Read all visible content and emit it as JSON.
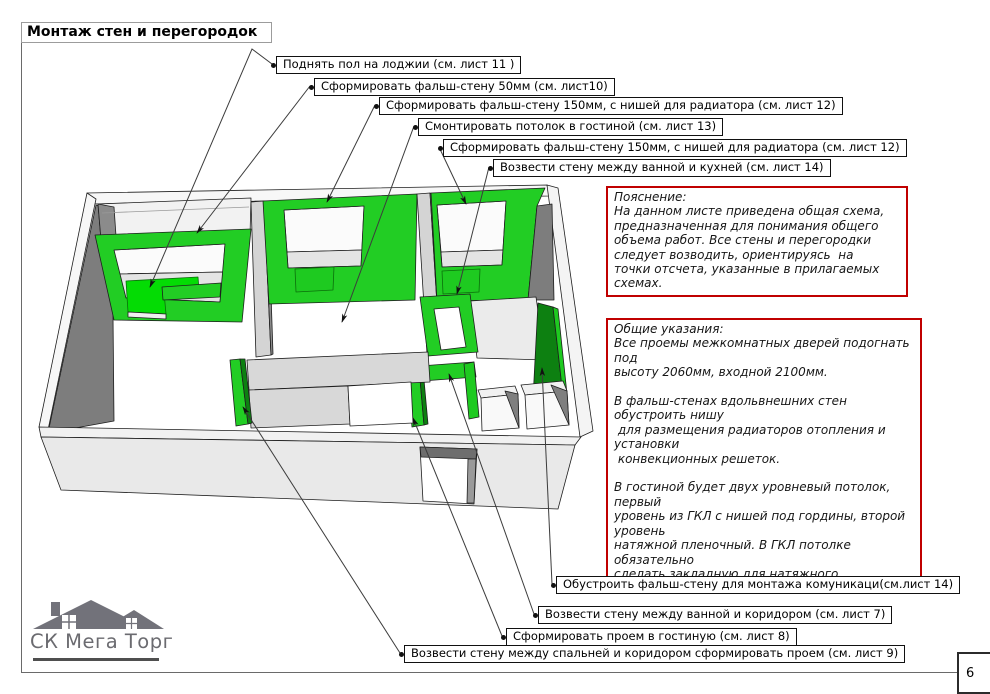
{
  "sheet": {
    "title": "Монтаж стен и перегородок",
    "page_number": "6"
  },
  "callouts": [
    {
      "label": "Поднять пол на лоджии (см. лист 11 )"
    },
    {
      "label": "Сформировать фальш-стену 50мм (см. лист10)"
    },
    {
      "label": "Сформировать фальш-стену 150мм, с нишей для радиатора (см. лист 12)"
    },
    {
      "label": "Смонтировать потолок в гостиной  (см. лист 13)"
    },
    {
      "label": "Сформировать фальш-стену 150мм, с нишей для радиатора (см. лист 12)"
    },
    {
      "label": "Возвести стену между ванной и кухней (см. лист 14)"
    },
    {
      "label": "Обустроить фальш-стену для монтажа комуникаци(см.лист 14)"
    },
    {
      "label": "Возвести стену между ванной и коридором (см. лист 7)"
    },
    {
      "label": "Сформировать проем в гостиную  (см. лист 8)"
    },
    {
      "label": "Возвести стену между спальней и коридором сформировать проем  (см. лист 9)"
    }
  ],
  "notes": {
    "explanation": {
      "title": "Пояснение:",
      "body": "На данном листе приведена общая схема,\nпредназначенная для понимания общего\nобъема работ. Все стены и перегородки\nследует возводить, ориентируясь  на\nточки отсчета, указанные в прилагаемых\nсхемах."
    },
    "general": {
      "title": "Общие указания:",
      "body": "Все проемы межкомнатных дверей подогнать под\nвысоту 2060мм, входной 2100мм.\n\nВ фальш-стенах вдольвнешних стен обустроить нишу\n для размещения радиаторов отопления и установки\n конвекционных решеток.\n\nВ гостиной будет двух уровневый потолок, первый\nуровень из ГКЛ с нишей под гордины, второй уровень\nнатяжной пленочный. В ГКЛ потолке обязательно\nсделать закладную для натяжного."
    }
  },
  "logo": {
    "company": "СК Мега Торг"
  },
  "colors": {
    "new_wall_green": "#22CD24",
    "new_floor_green": "#04DC04",
    "dark_green": "#0D8011",
    "note_border": "#C00000",
    "logo_gray": "#72727A"
  }
}
